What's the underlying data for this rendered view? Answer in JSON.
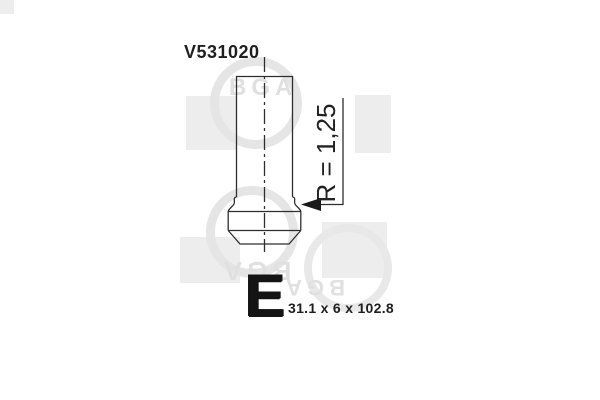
{
  "drawing": {
    "part_number": "V531020",
    "radius_label": "R = 1,25",
    "size_letter": "E",
    "dimensions": "31.1 x 6 x 102.8"
  },
  "watermark": {
    "brand": "BGA"
  },
  "colors": {
    "background": "#ffffff",
    "line": "#2e2e2e",
    "text": "#1f1f1f",
    "watermark_gray": "#e7e7e7"
  }
}
